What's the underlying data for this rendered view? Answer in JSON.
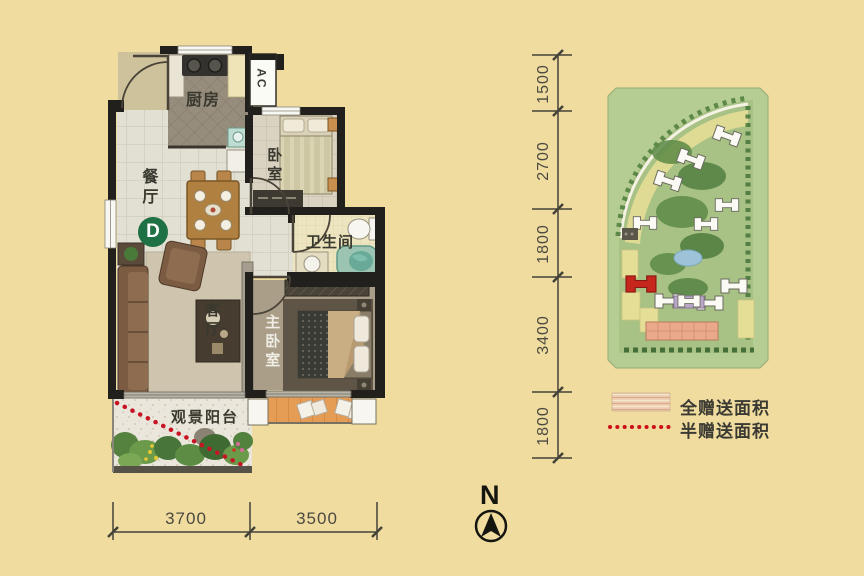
{
  "floorplan": {
    "unit_badge": "D",
    "rooms": {
      "kitchen": "厨房",
      "dining": "餐厅",
      "bedroom": "卧室",
      "bathroom": "卫生间",
      "living": "客厅",
      "master_bedroom": "主卧室",
      "balcony": "观景阳台"
    },
    "ac_label": "AC",
    "dim_bottom": [
      "3700",
      "3500"
    ],
    "dim_right": [
      "1500",
      "2700",
      "1800",
      "3400",
      "1800"
    ]
  },
  "legend": {
    "items": [
      {
        "swatch": "wood-texture-swatch",
        "label": "全赠送面积"
      },
      {
        "swatch": "red-dotted-line",
        "label": "半赠送面积"
      }
    ]
  },
  "compass": {
    "label": "N"
  },
  "colors": {
    "background": "#f0dc9f",
    "wall": "#22201c",
    "badge_green": "#1e7144",
    "dotted_red": "#c81422",
    "siteplan_field_green": "#b5cd92",
    "siteplan_highlight_red": "#c6261c",
    "legend_wood": "#eed2b4"
  }
}
